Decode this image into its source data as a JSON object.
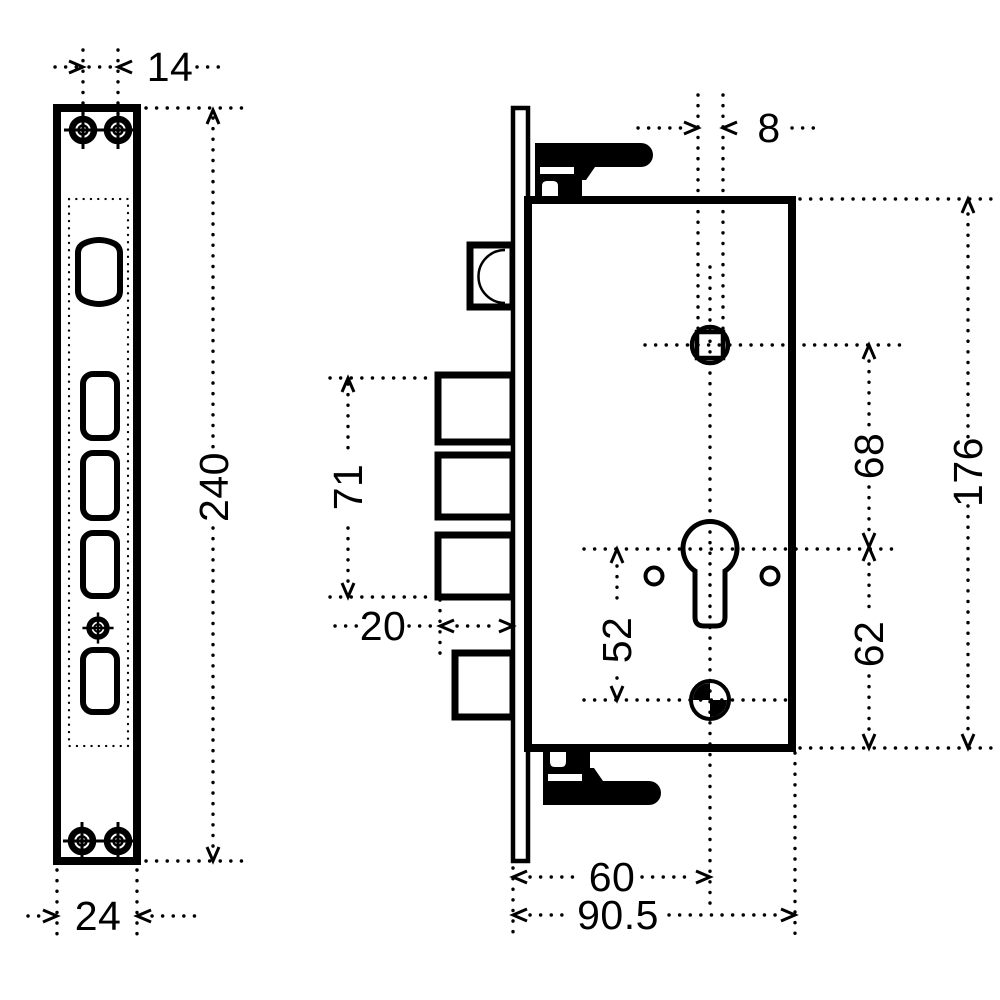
{
  "meta": {
    "type": "technical-drawing",
    "subject": "mortise door lock dimensional diagram",
    "units": "mm",
    "views": [
      "faceplate-front-view",
      "lock-case-side-view"
    ]
  },
  "colors": {
    "line": "#000000",
    "background": "#ffffff"
  },
  "front_view": {
    "name": "faceplate front view",
    "dimensions": {
      "screw_hole_spacing": "14",
      "faceplate_height": "240",
      "faceplate_width": "24"
    }
  },
  "side_view": {
    "name": "lock case side view",
    "dimensions": {
      "follower_square": "8",
      "deadbolt_span": "71",
      "bolt_throw": "20",
      "cylinder_to_fix_screw": "52",
      "follower_to_cylinder": "68",
      "case_height": "176",
      "cylinder_to_case_bottom": "62",
      "backset": "60",
      "case_depth": "90.5"
    }
  }
}
